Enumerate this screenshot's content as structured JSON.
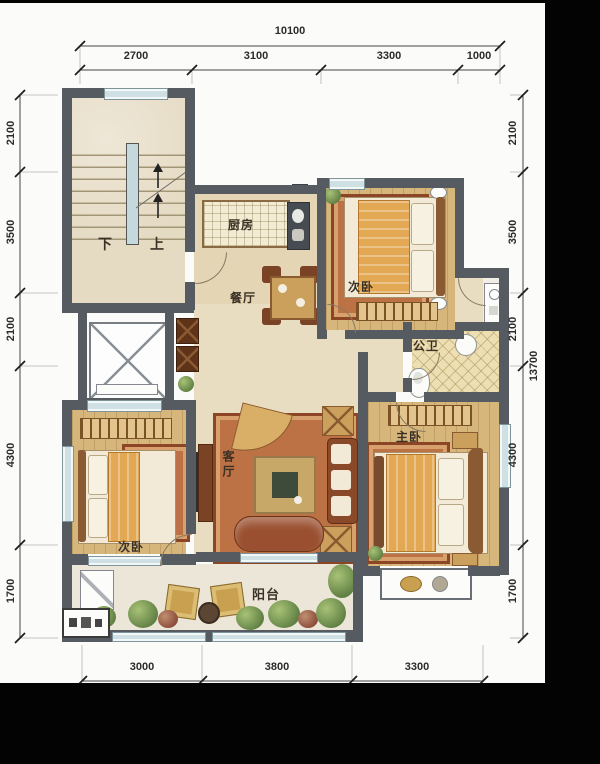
{
  "dimensions": {
    "top": {
      "total": "10100",
      "segments": [
        "2700",
        "3100",
        "3300",
        "1000"
      ]
    },
    "left": {
      "segments": [
        "2100",
        "3500",
        "2100",
        "4300",
        "1700"
      ]
    },
    "right": {
      "segments": [
        "2100",
        "3500",
        "2100",
        "4300",
        "1700"
      ],
      "total": "13700"
    },
    "bottom": {
      "segments": [
        "3000",
        "3800",
        "3300"
      ]
    }
  },
  "rooms": {
    "kitchen": "厨房",
    "dining": "餐厅",
    "bedroom_top": "次卧",
    "bathroom": "公卫",
    "master_bedroom": "主卧",
    "living_room": "客厅",
    "bedroom_left": "次卧",
    "balcony": "阳台"
  },
  "stairs": {
    "down": "下",
    "up": "上"
  },
  "colors": {
    "wall": "#565a61",
    "wood_floor": "#d7b67b",
    "window_glass": "#cfe0e4",
    "rug": "#bc7244",
    "hall_floor": "#e8ddc1"
  }
}
